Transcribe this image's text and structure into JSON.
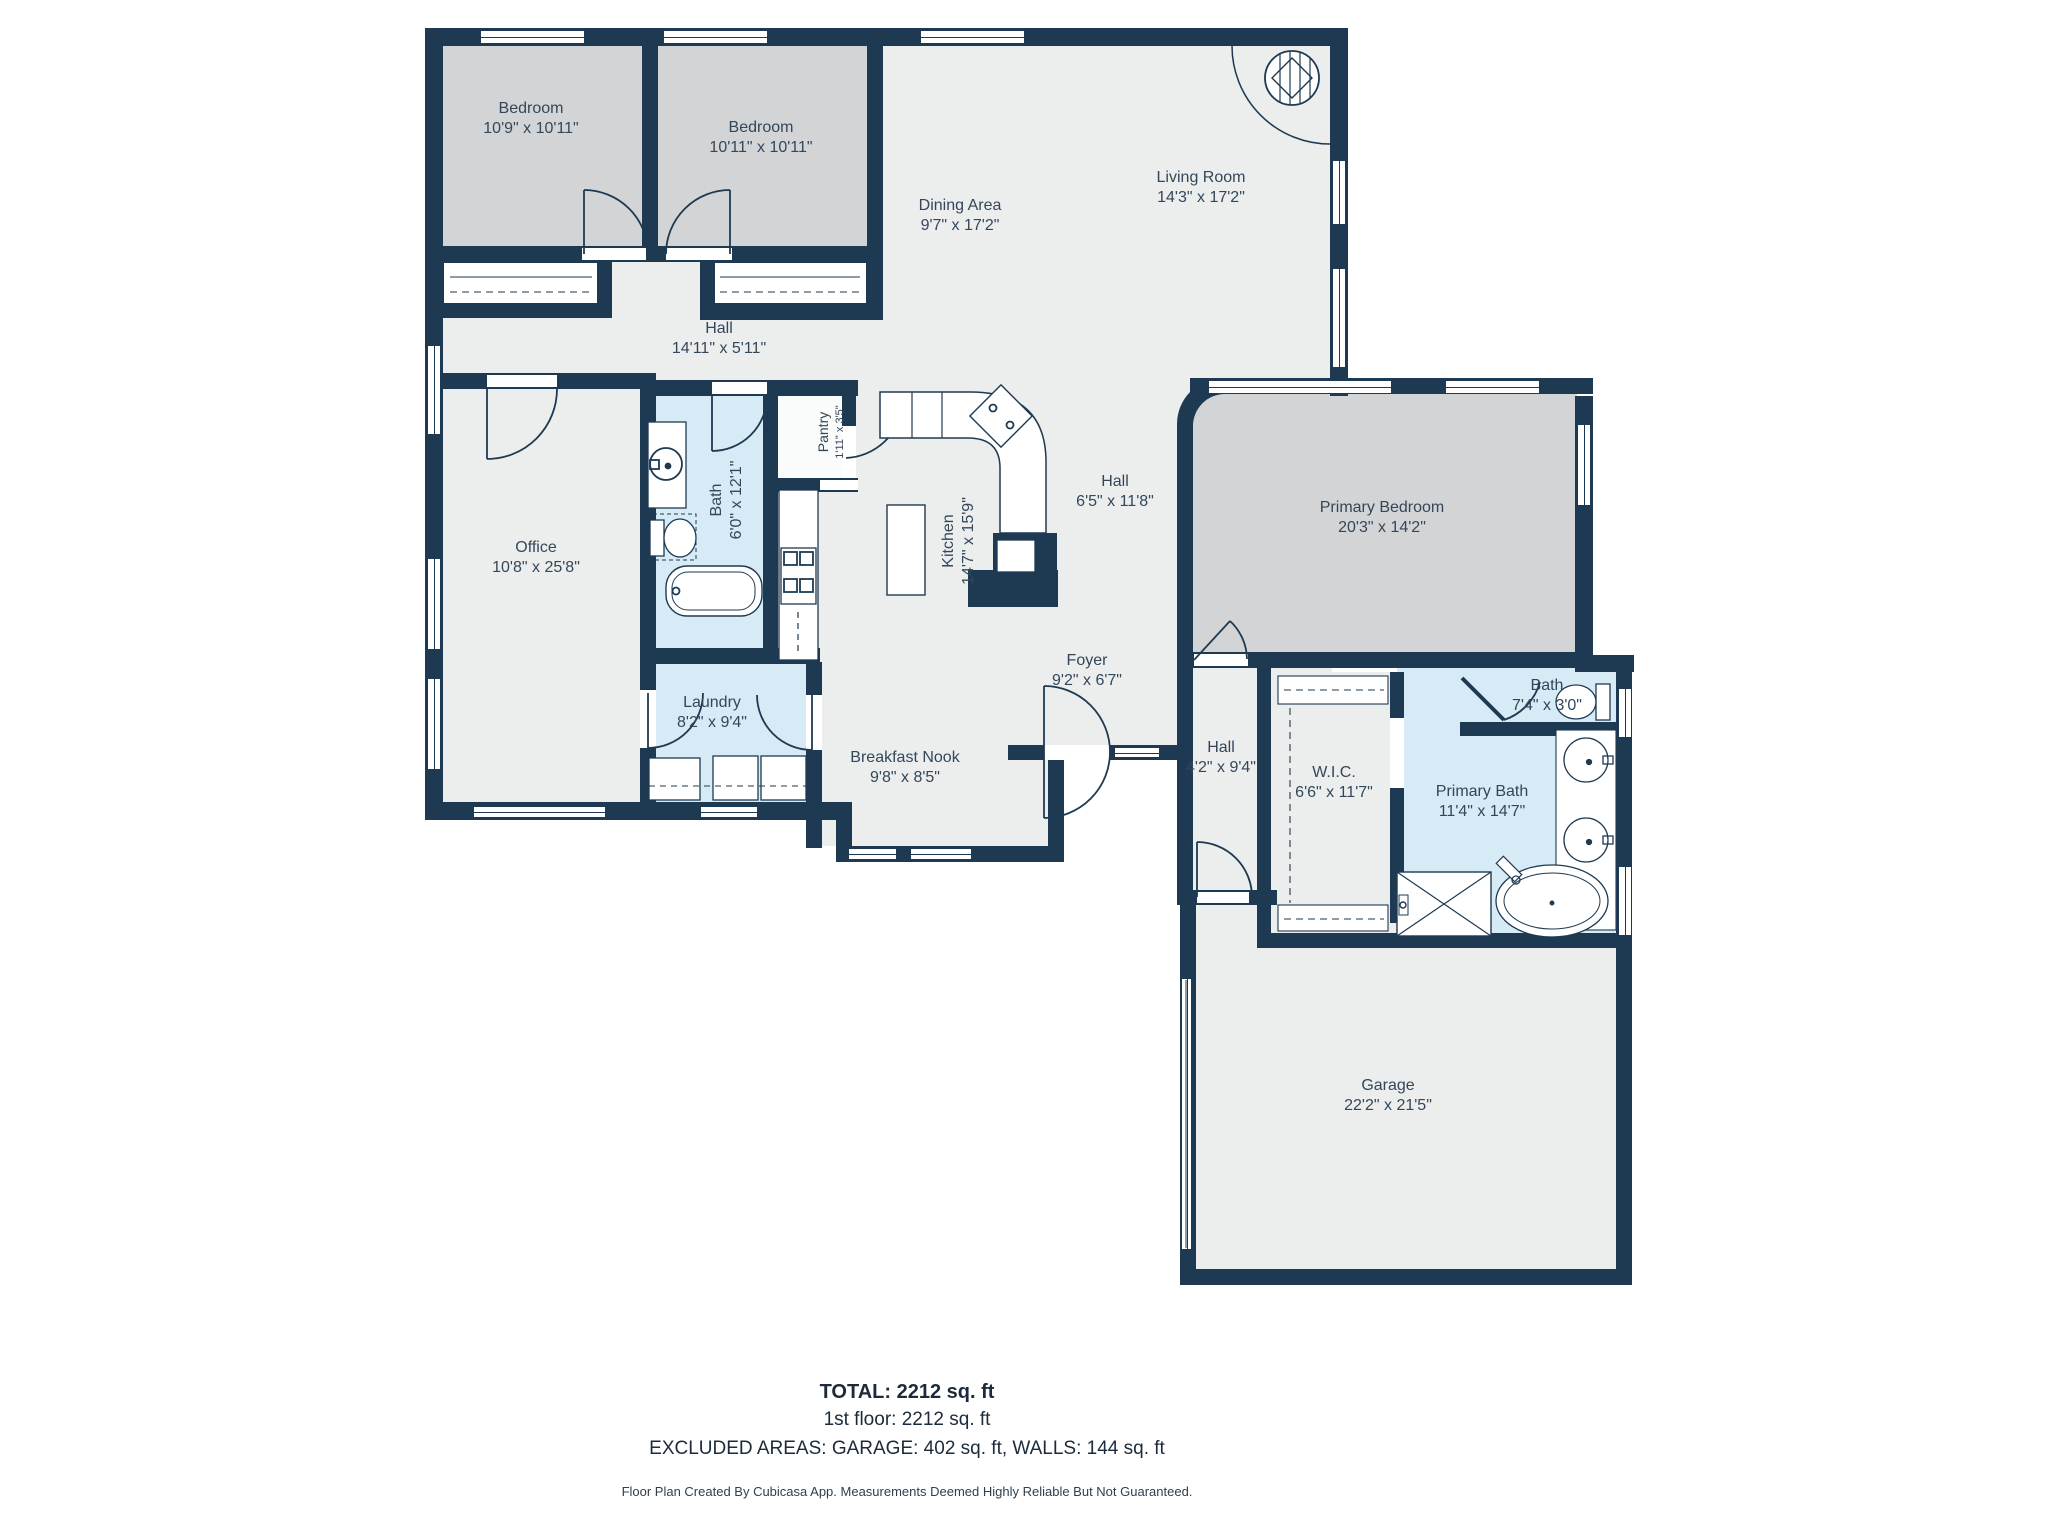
{
  "summary": {
    "total": "TOTAL: 2212 sq. ft",
    "floor1": "1st floor: 2212 sq. ft",
    "excluded": "EXCLUDED AREAS: GARAGE: 402 sq. ft, WALLS: 144 sq. ft"
  },
  "footer": {
    "disclaimer": "Floor Plan Created By Cubicasa App. Measurements Deemed Highly Reliable But Not Guaranteed."
  },
  "colors": {
    "wall": "#1E3A52",
    "floor": "#ECEDED",
    "bedroom_floor": "#D2D4D6",
    "wet_floor": "#D6EBF6",
    "label_text": "#33475A",
    "summary_text": "#1C2B3B"
  },
  "rooms": [
    {
      "id": "bedroom-1",
      "name": "Bedroom",
      "dims": "10'9\" x 10'11\""
    },
    {
      "id": "bedroom-2",
      "name": "Bedroom",
      "dims": "10'11\" x 10'11\""
    },
    {
      "id": "dining-area",
      "name": "Dining Area",
      "dims": "9'7\" x 17'2\""
    },
    {
      "id": "living-room",
      "name": "Living Room",
      "dims": "14'3\" x 17'2\""
    },
    {
      "id": "hall-north",
      "name": "Hall",
      "dims": "14'11\" x 5'11\""
    },
    {
      "id": "office",
      "name": "Office",
      "dims": "10'8\" x 25'8\""
    },
    {
      "id": "bath",
      "name": "Bath",
      "dims": "6'0\" x 12'1\""
    },
    {
      "id": "pantry",
      "name": "Pantry",
      "dims": "1'11\" x 3'5\""
    },
    {
      "id": "kitchen",
      "name": "Kitchen",
      "dims": "14'7\" x 15'9\""
    },
    {
      "id": "hall-center",
      "name": "Hall",
      "dims": "6'5\" x 11'8\""
    },
    {
      "id": "primary-bedroom",
      "name": "Primary Bedroom",
      "dims": "20'3\" x 14'2\""
    },
    {
      "id": "foyer",
      "name": "Foyer",
      "dims": "9'2\" x 6'7\""
    },
    {
      "id": "laundry",
      "name": "Laundry",
      "dims": "8'2\" x 9'4\""
    },
    {
      "id": "breakfast-nook",
      "name": "Breakfast Nook",
      "dims": "9'8\" x 8'5\""
    },
    {
      "id": "hall-south",
      "name": "Hall",
      "dims": "4'2\" x 9'4\""
    },
    {
      "id": "wic",
      "name": "W.I.C.",
      "dims": "6'6\" x 11'7\""
    },
    {
      "id": "bath-2",
      "name": "Bath",
      "dims": "7'4\" x 3'0\""
    },
    {
      "id": "primary-bath",
      "name": "Primary Bath",
      "dims": "11'4\" x 14'7\""
    },
    {
      "id": "garage",
      "name": "Garage",
      "dims": "22'2\" x 21'5\""
    }
  ]
}
